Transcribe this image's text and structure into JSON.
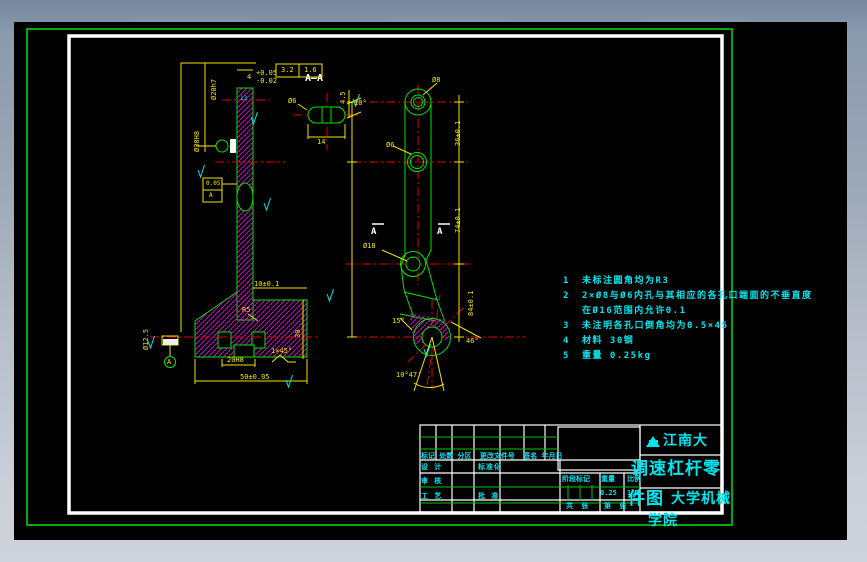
{
  "colors": {
    "outline_green": "#00e400",
    "dim_yellow": "#f5e400",
    "center_red": "#e60000",
    "hatch_magenta": "#e800e8",
    "text_cyan": "#00e5ee",
    "sheet_white": "#ffffff"
  },
  "section": {
    "label": "A—A",
    "arrow_left": "A",
    "arrow_right": "A"
  },
  "dims": {
    "aa_dia": "Ø6",
    "aa_h": "4.5",
    "aa_w": "14",
    "aa_angle": "10°",
    "lv_rough_a": "3.2",
    "lv_rough_b": "1.6",
    "lv_w4": "4",
    "lv_tol_up": "+0.05",
    "lv_tol_dn": "-0.02",
    "lv_dia_top": "Ø20h7",
    "lv_dia_mid": "Ø30H8",
    "lv_dia_left": "Ø12.5",
    "lv_gdt_val": "0.05",
    "lv_gdt_ref": "A",
    "lv_cyan": "13",
    "lv_pad": "10±0.1",
    "lv_r5": "R5",
    "lv_slot": "20H8",
    "lv_base": "50±0.05",
    "lv_chamfer": "1×45°",
    "lv_h30": "30",
    "rv_d8": "Ø8",
    "rv_d6": "Ø6",
    "rv_d18": "Ø18",
    "rv_36": "36±0.1",
    "rv_74": "74±0.1",
    "rv_84": "84±0.1",
    "rv_15": "15°",
    "rv_46": "46°",
    "rv_1047": "10°47′",
    "datum_a": "A"
  },
  "notes": {
    "items": [
      {
        "no": "1",
        "text": "未标注圆角均为R3"
      },
      {
        "no": "2",
        "text": "2×Ø8与Ø6内孔与其相应的各孔口端面的不垂直度"
      },
      {
        "no": "",
        "text": "在Ø16范围内允许0.1"
      },
      {
        "no": "3",
        "text": "未注明各孔口倒角均为0.5×45"
      },
      {
        "no": "4",
        "text": "材料 30钢"
      },
      {
        "no": "5",
        "text": "重量 0.25kg"
      }
    ]
  },
  "title_block": {
    "rev_header": "标记 处数 分区  更改文件号  签名 年月日",
    "design": "设 计",
    "standard": "标准化",
    "check": "审 核",
    "process": "工 艺",
    "approve": "批 准",
    "stage_label": "阶段标记",
    "weight_label": "重量",
    "scale_label": "比例",
    "weight_value": "0.25",
    "scale_value": "1:1",
    "sheet_label": "共  张",
    "page_label": "第  张",
    "school_1": "江南大",
    "school_2": "大学机械",
    "school_3": "学院",
    "title_1": "调速杠杆零",
    "title_2": "件图"
  }
}
